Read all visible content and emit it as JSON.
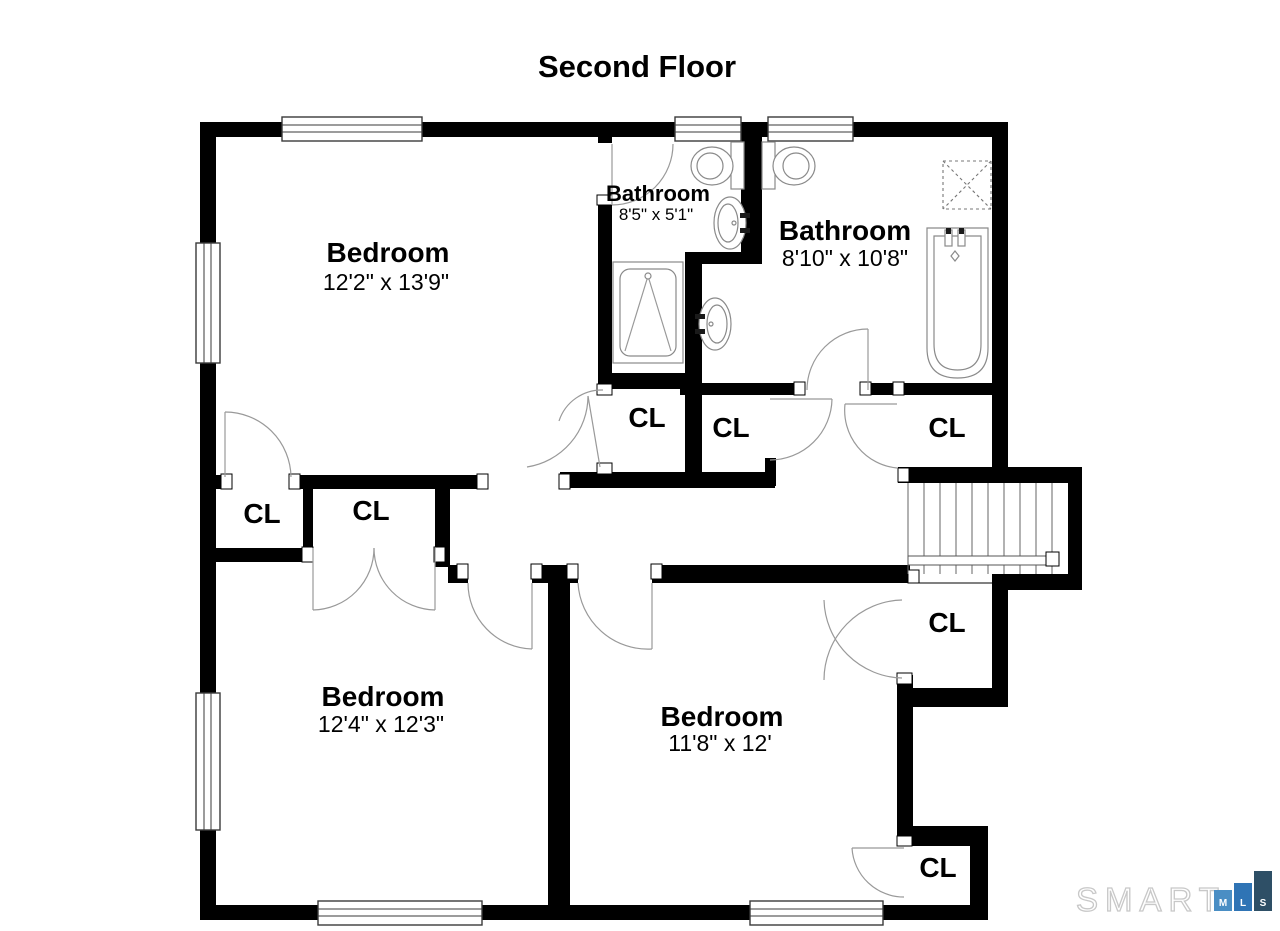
{
  "title": "Second Floor",
  "rooms": {
    "bedroom_top_left": {
      "name": "Bedroom",
      "dims": "12'2\" x 13'9\""
    },
    "bathroom_small": {
      "name": "Bathroom",
      "dims": "8'5\" x 5'1\""
    },
    "bathroom_large": {
      "name": "Bathroom",
      "dims": "8'10\" x 10'8\""
    },
    "bedroom_bottom_left": {
      "name": "Bedroom",
      "dims": "12'4\" x 12'3\""
    },
    "bedroom_bottom_right": {
      "name": "Bedroom",
      "dims": "11'8\" x 12'"
    }
  },
  "closets": {
    "items": [
      {
        "label": "CL"
      },
      {
        "label": "CL"
      },
      {
        "label": "CL"
      },
      {
        "label": "CL"
      },
      {
        "label": "CL"
      },
      {
        "label": "CL"
      },
      {
        "label": "CL"
      }
    ]
  },
  "fixtures": {
    "icons": [
      "toilet-icon",
      "sink-icon",
      "shower-stall-icon",
      "shower-pan-icon",
      "bathtub-icon",
      "staircase"
    ]
  },
  "logo": {
    "brand": "SMART",
    "blocks": [
      {
        "letter": "M",
        "color": "#4A8EC4"
      },
      {
        "letter": "L",
        "color": "#2F74B5"
      },
      {
        "letter": "S",
        "color": "#2E4F66"
      }
    ]
  },
  "colors": {
    "wall": "#000000",
    "background": "#ffffff",
    "fixture_line": "#8a8a8a",
    "door_line": "#999999"
  }
}
